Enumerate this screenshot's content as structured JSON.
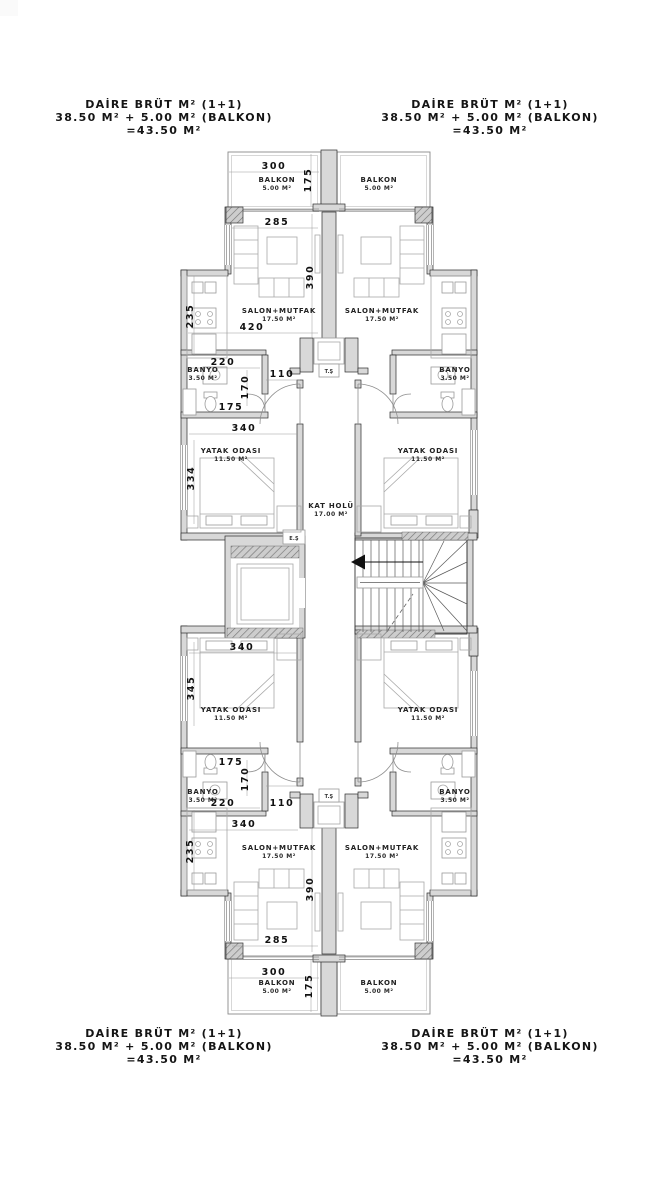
{
  "summary": {
    "line1": "DAİRE BRÜT M² (1+1)",
    "line2": "38.50 M² + 5.00 M² (BALKON)",
    "line3": "=43.50 M²"
  },
  "rooms": {
    "balkon": {
      "name": "BALKON",
      "area": "5.00 M²"
    },
    "salon": {
      "name": "SALON+MUTFAK",
      "area": "17.50 M²"
    },
    "banyo": {
      "name": "BANYO",
      "area": "3.50 M²"
    },
    "yatak": {
      "name": "YATAK ODASI",
      "area": "11.50 M²"
    },
    "hol": {
      "name": "KAT HOLÜ",
      "area": "17.00 M²"
    }
  },
  "shafts": {
    "elevator": "E.Ş",
    "utility": "T.Ş"
  },
  "dims": {
    "n110": "110",
    "n170": "170",
    "n175": "175",
    "n220": "220",
    "n235": "235",
    "n285": "285",
    "n300": "300",
    "n334": "334",
    "n340": "340",
    "n345": "345",
    "n390": "390",
    "n420": "420"
  },
  "colors": {
    "wall_fill": "#d8d8d8",
    "hatch": "#c8c8c8",
    "line": "#2b2b2b",
    "furniture": "#a8a8a8",
    "text": "#141414",
    "background": "#ffffff"
  }
}
